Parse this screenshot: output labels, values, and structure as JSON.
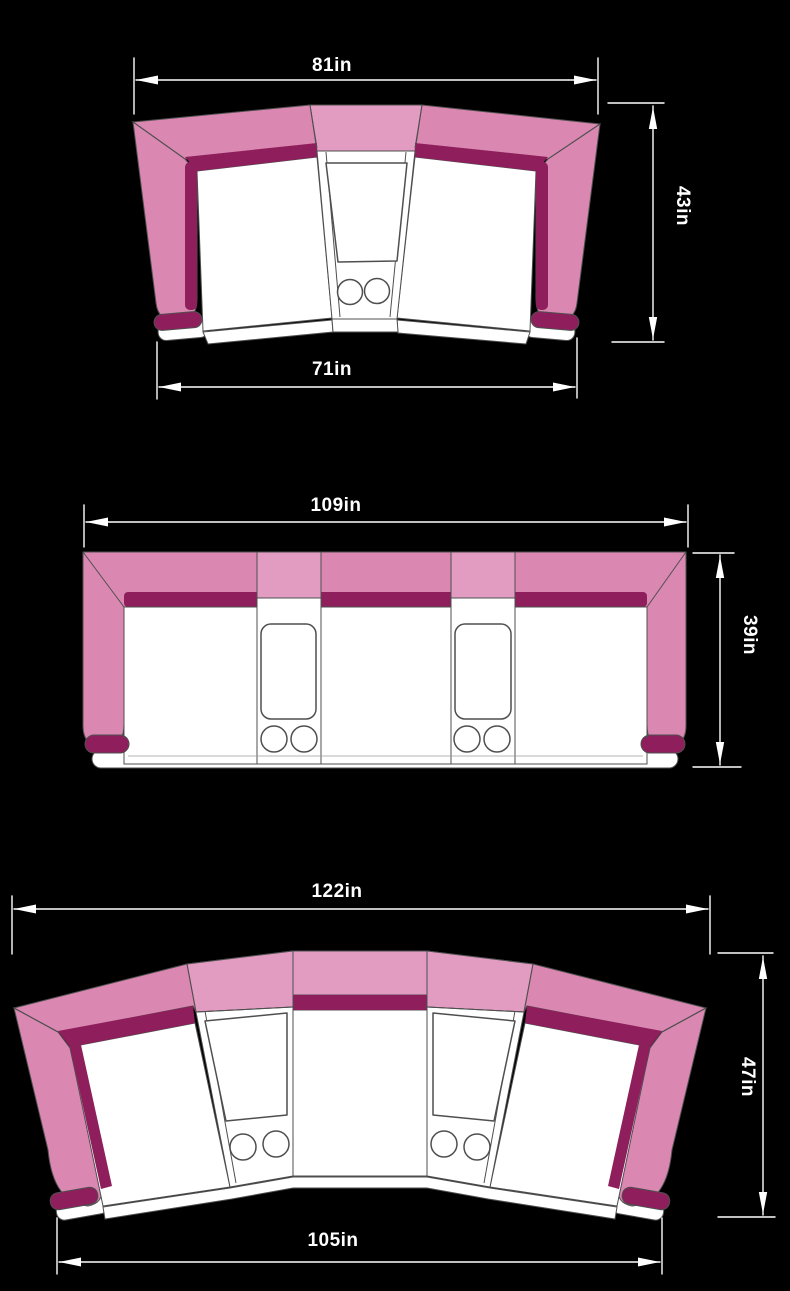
{
  "title": "Sofa dimension diagrams",
  "colors": {
    "background": "#000000",
    "pink": "#da87b1",
    "pink_light": "#e29bc1",
    "accent": "#8e1f5c",
    "outline": "#4f4f4f",
    "seat": "#ffffff",
    "dimension": "#ffffff"
  },
  "diagrams": [
    {
      "name": "curved loveseat with center console",
      "dims": {
        "back_width": "81in",
        "depth": "43in",
        "front_width": "71in"
      }
    },
    {
      "name": "straight three-seat sofa with two consoles",
      "dims": {
        "back_width": "109in",
        "depth": "39in"
      }
    },
    {
      "name": "curved three-seat sofa with two consoles",
      "dims": {
        "back_width": "122in",
        "depth": "47in",
        "front_width": "105in"
      }
    }
  ]
}
